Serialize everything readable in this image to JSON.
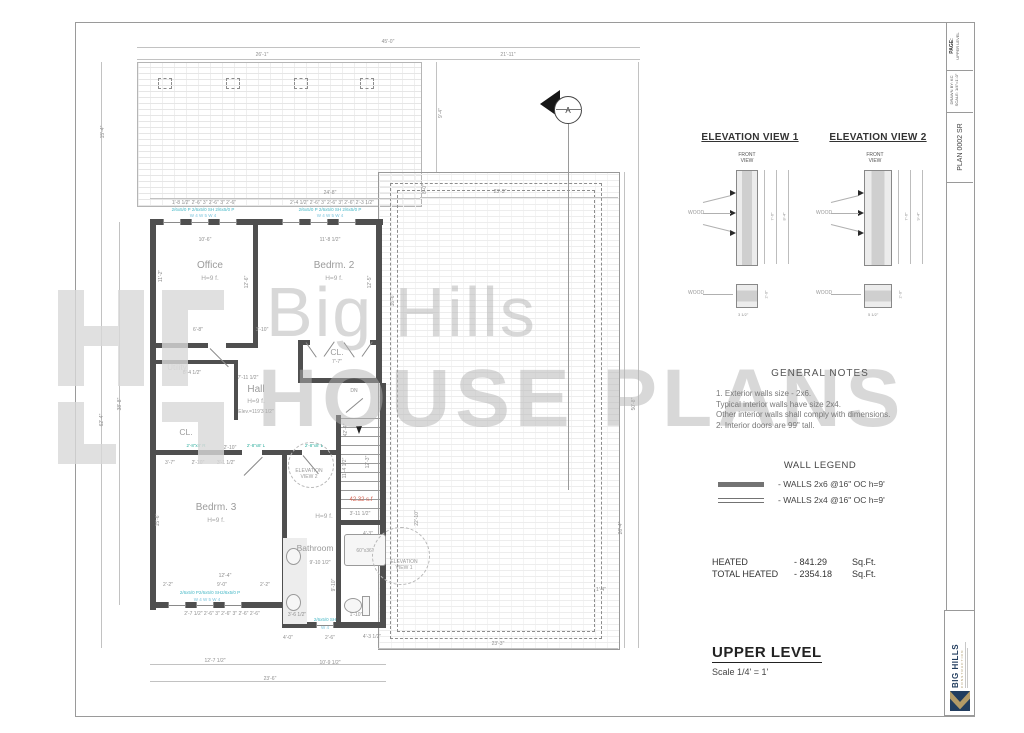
{
  "watermark": {
    "line1": "Big Hills",
    "line2": "HOUSE PLANS"
  },
  "titleblock": {
    "page_label": "PAGE:",
    "page_value": "UPPER LEVEL",
    "drawn_by": "DRAWN BY: KC",
    "scale": "SCALE: 1/4\"=1'-0\"",
    "plan_number": "PLAN 0002 SR"
  },
  "logo": {
    "name": "BIG HILLS",
    "subtitle": "CONSTRUCTION"
  },
  "section_marker": "A",
  "elevations": [
    {
      "title": "ELEVATION VIEW 1",
      "front_view": "FRONT VIEW",
      "wood_upper": "WOOD",
      "wood_lower": "WOOD",
      "dim_inner": "7'-6\"",
      "dim_outer": "8'-4\"",
      "dim_width": "3 1/2\"",
      "dim_thick": "2'-0\""
    },
    {
      "title": "ELEVATION VIEW 2",
      "front_view": "FRONT VIEW",
      "wood_upper": "WOOD",
      "wood_lower": "WOOD",
      "dim_inner": "7'-6\"",
      "dim_outer": "9'-4\"",
      "dim_width": "5 1/2\"",
      "dim_thick": "2'-0\""
    }
  ],
  "general_notes": {
    "title": "GENERAL NOTES",
    "lines": [
      "1. Exterior walls size - 2x6.",
      "Typical interior walls have size 2x4.",
      "Other interior walls shall comply with dimensions.",
      "2. Interior doors are 99\" tall."
    ]
  },
  "wall_legend": {
    "title": "WALL LEGEND",
    "items": [
      {
        "swatch": "thick",
        "label": "- WALLS 2x6 @16\" OC h=9'"
      },
      {
        "swatch": "double",
        "label": "- WALLS 2x4 @16\" OC h=9'"
      }
    ]
  },
  "areas": {
    "rows": [
      {
        "label": "HEATED",
        "value": "- 841.29",
        "unit": "Sq.Ft."
      },
      {
        "label": "TOTAL HEATED",
        "value": "- 2354.18",
        "unit": "Sq.Ft."
      }
    ]
  },
  "sheet_title": {
    "text": "UPPER LEVEL",
    "scale": "Scale   1/4' = 1'"
  },
  "plan": {
    "texts": [
      {
        "t": "Office",
        "x": 210,
        "y": 266,
        "c": "room"
      },
      {
        "t": "H=9 f.",
        "x": 210,
        "y": 279,
        "c": "rh"
      },
      {
        "t": "Bedrm. 2",
        "x": 334,
        "y": 266,
        "c": "room"
      },
      {
        "t": "H=9 f.",
        "x": 334,
        "y": 279,
        "c": "rh"
      },
      {
        "t": "Bedrm. 3",
        "x": 216,
        "y": 508,
        "c": "room"
      },
      {
        "t": "H=9 f.",
        "x": 216,
        "y": 521,
        "c": "rh"
      },
      {
        "t": "Hall",
        "x": 256,
        "y": 390,
        "c": "room"
      },
      {
        "t": "H=9 f.",
        "x": 256,
        "y": 402,
        "c": "rh"
      },
      {
        "t": "Elev.=119'3 1/2\"",
        "x": 256,
        "y": 412,
        "c": "ann"
      },
      {
        "t": "CL.",
        "x": 337,
        "y": 352,
        "c": "room2"
      },
      {
        "t": "7'-7\"",
        "x": 337,
        "y": 362
      },
      {
        "t": "CL.",
        "x": 186,
        "y": 432,
        "c": "room2"
      },
      {
        "t": "Utility",
        "x": 177,
        "y": 368,
        "c": "faded"
      },
      {
        "t": "Bathroom",
        "x": 315,
        "y": 548,
        "c": "room2"
      },
      {
        "t": "H=9 f.",
        "x": 324,
        "y": 517,
        "c": "rh"
      },
      {
        "t": "DN",
        "x": 354,
        "y": 391
      },
      {
        "t": "42.32 s.f",
        "x": 361,
        "y": 500,
        "c": "red"
      },
      {
        "t": "ELEVATION\nVIEW 2",
        "x": 309,
        "y": 474,
        "c": "ann"
      },
      {
        "t": "ELEVATION\nVIEW 1",
        "x": 404,
        "y": 565,
        "c": "ann"
      },
      {
        "t": "45'-0\"",
        "x": 388,
        "y": 42
      },
      {
        "t": "26'-1\"",
        "x": 262,
        "y": 55
      },
      {
        "t": "21'-11\"",
        "x": 508,
        "y": 55
      },
      {
        "t": "15'-4\"",
        "x": 103,
        "y": 132,
        "r": 1
      },
      {
        "t": "24'-8\"",
        "x": 330,
        "y": 193
      },
      {
        "t": "23'-3\"",
        "x": 500,
        "y": 192
      },
      {
        "t": "9'-4\"",
        "x": 441,
        "y": 113,
        "r": 1
      },
      {
        "t": "8'-0\"",
        "x": 425,
        "y": 189,
        "r": 1
      },
      {
        "t": "62'-4\"",
        "x": 102,
        "y": 420,
        "r": 1
      },
      {
        "t": "38'-8\"",
        "x": 120,
        "y": 404,
        "r": 1
      },
      {
        "t": "16'-6\"",
        "x": 393,
        "y": 300,
        "r": 1
      },
      {
        "t": "50'-8\"",
        "x": 634,
        "y": 404,
        "r": 1
      },
      {
        "t": "26'-4\"",
        "x": 621,
        "y": 528,
        "r": 1
      },
      {
        "t": "42'-4\"",
        "x": 346,
        "y": 430,
        "r": 1
      },
      {
        "t": "22'-10\"",
        "x": 417,
        "y": 518,
        "r": 1
      },
      {
        "t": "1'-4\"",
        "x": 601,
        "y": 590
      },
      {
        "t": "11'-2\"",
        "x": 161,
        "y": 276,
        "r": 1
      },
      {
        "t": "12'-6\"",
        "x": 247,
        "y": 282,
        "r": 1
      },
      {
        "t": "12'-5\"",
        "x": 370,
        "y": 282,
        "r": 1
      },
      {
        "t": "10'-6\"",
        "x": 205,
        "y": 240
      },
      {
        "t": "11'-8 1/2\"",
        "x": 330,
        "y": 240
      },
      {
        "t": "6'-8\"",
        "x": 198,
        "y": 330
      },
      {
        "t": "3'-10\"",
        "x": 262,
        "y": 330
      },
      {
        "t": "8'-4 1/2\"",
        "x": 192,
        "y": 373
      },
      {
        "t": "7'-11 1/2\"",
        "x": 248,
        "y": 378
      },
      {
        "t": "1'-8 1/2\" 2'-6\" 3\" 2'-6\" 3\" 2'-6\"",
        "x": 204,
        "y": 203
      },
      {
        "t": "2'-4 1/2\" 2'-6\" 3\" 2'-6\" 3\" 2'-6\" 2'-3 1/2\"",
        "x": 332,
        "y": 203
      },
      {
        "t": "2/6x5/0 P 2/6x5/0 SH 2/6x5/0 P",
        "x": 203,
        "y": 210,
        "c": "winl"
      },
      {
        "t": "W 4        W 5        W 4",
        "x": 203,
        "y": 216,
        "c": "winl2"
      },
      {
        "t": "2/6x5/0 P 2/6x5/0 SH 2/6x5/0 P",
        "x": 330,
        "y": 210,
        "c": "winl"
      },
      {
        "t": "W 4        W 5        W 4",
        "x": 330,
        "y": 216,
        "c": "winl2"
      },
      {
        "t": "2'-8\"x8' R",
        "x": 196,
        "y": 446,
        "c": "door"
      },
      {
        "t": "2'-8\"x8' L",
        "x": 256,
        "y": 446,
        "c": "door"
      },
      {
        "t": "2'-8\"x8' L",
        "x": 314,
        "y": 446,
        "c": "door"
      },
      {
        "t": "3'-7\"",
        "x": 170,
        "y": 463
      },
      {
        "t": "2'-10\"",
        "x": 198,
        "y": 463
      },
      {
        "t": "3'-1 1/2\"",
        "x": 226,
        "y": 463
      },
      {
        "t": "15'-6\"",
        "x": 158,
        "y": 520,
        "r": 1
      },
      {
        "t": "12'-4\"",
        "x": 225,
        "y": 576
      },
      {
        "t": "9'-0\"",
        "x": 222,
        "y": 585
      },
      {
        "t": "2'-2\"",
        "x": 168,
        "y": 585
      },
      {
        "t": "2'-2\"",
        "x": 265,
        "y": 585
      },
      {
        "t": "2/6x5/0 P2/6x5/0 SH2/6x5/0 P",
        "x": 210,
        "y": 593,
        "c": "winl"
      },
      {
        "t": "W 4        W 5        W 4",
        "x": 207,
        "y": 600,
        "c": "winl2"
      },
      {
        "t": "2'-7 1/2\"  2'-6\"  3\"  2'-6\"  3\"  2'-6\"  2'-6\"",
        "x": 222,
        "y": 614
      },
      {
        "t": "3'-6 1/2\"",
        "x": 297,
        "y": 615
      },
      {
        "t": "1'-10\"",
        "x": 356,
        "y": 615
      },
      {
        "t": "2/6x5/0 SH",
        "x": 325,
        "y": 620,
        "c": "winl"
      },
      {
        "t": "W 4",
        "x": 325,
        "y": 628,
        "c": "winl2"
      },
      {
        "t": "4'-0\"",
        "x": 288,
        "y": 638
      },
      {
        "t": "2'-6\"",
        "x": 330,
        "y": 638
      },
      {
        "t": "4'-3 1/2\"",
        "x": 372,
        "y": 637
      },
      {
        "t": "12'-7 1/2\"",
        "x": 215,
        "y": 661
      },
      {
        "t": "10'-9 1/2\"",
        "x": 330,
        "y": 663
      },
      {
        "t": "23'-6\"",
        "x": 270,
        "y": 679
      },
      {
        "t": "23'-3\"",
        "x": 498,
        "y": 644
      },
      {
        "t": "3'-11 1/2\"",
        "x": 360,
        "y": 514
      },
      {
        "t": "11'-4 1/2\"",
        "x": 345,
        "y": 468,
        "r": 1
      },
      {
        "t": "12'-3\"",
        "x": 368,
        "y": 462,
        "r": 1
      },
      {
        "t": "4'-3\"",
        "x": 368,
        "y": 534
      },
      {
        "t": "9'-10 1/2\"",
        "x": 320,
        "y": 563
      },
      {
        "t": "60\"x36\"",
        "x": 365,
        "y": 551,
        "c": "ann"
      },
      {
        "t": "9'-10\"",
        "x": 334,
        "y": 585,
        "r": 1
      },
      {
        "t": "2'-10\"",
        "x": 230,
        "y": 448
      }
    ]
  }
}
